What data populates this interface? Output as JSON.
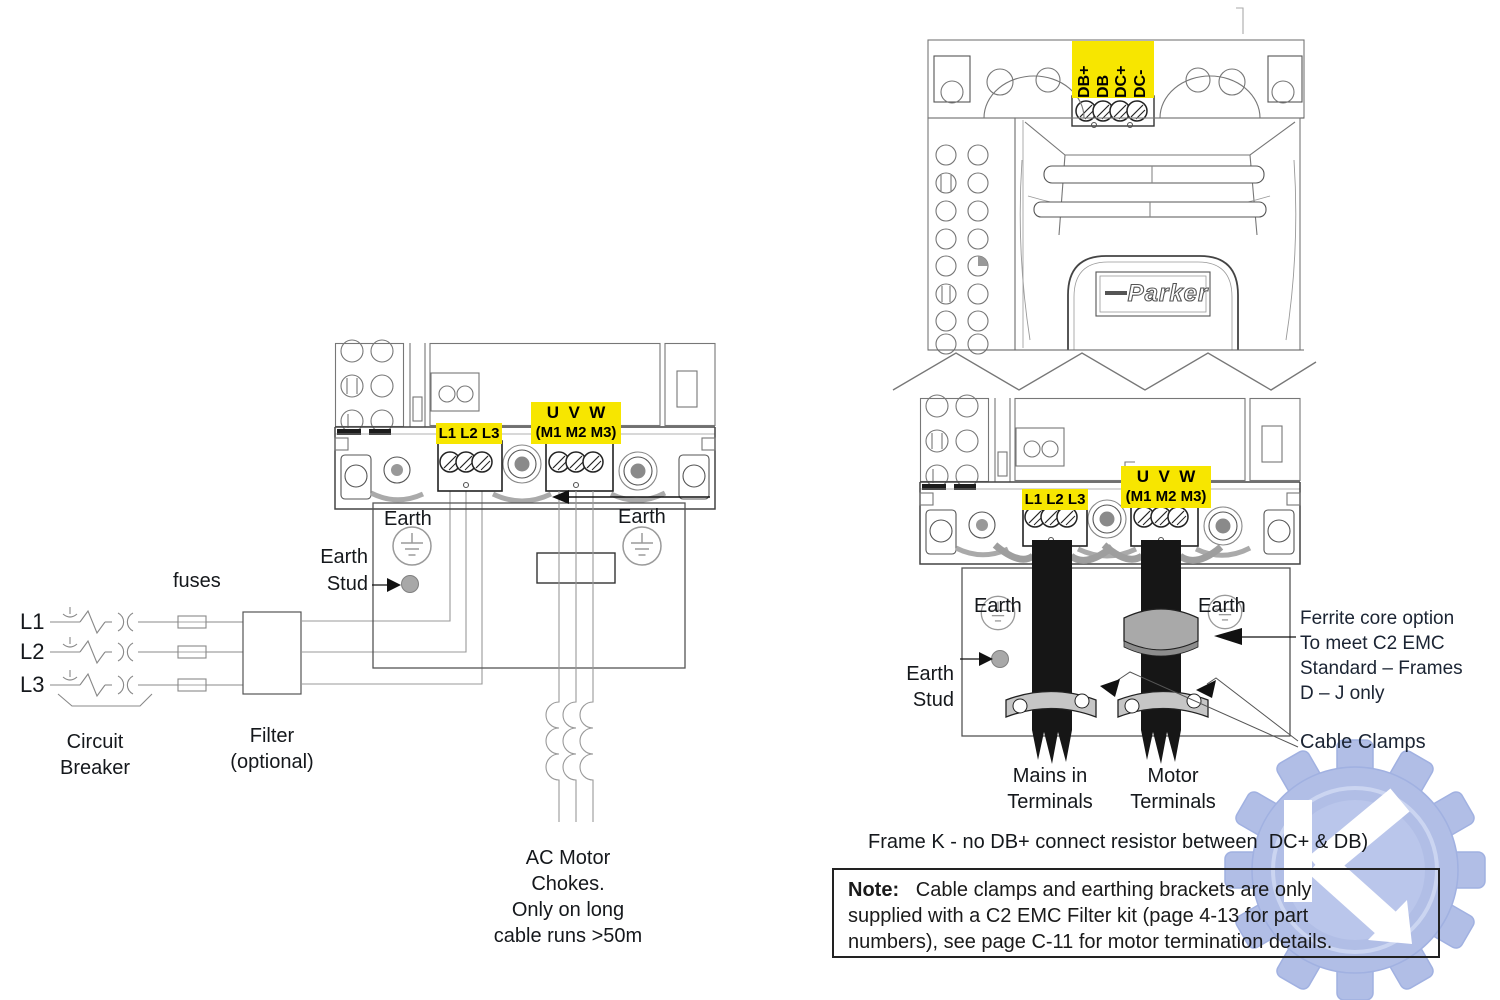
{
  "colors": {
    "highlight_yellow": "#F7E600",
    "watermark_blue": "#ADBBE5",
    "cable_black": "#161616",
    "clamp_gray": "#C6C6C6",
    "ferrite_gray": "#A9A9A9",
    "line_gray": "#777777",
    "text_black": "#15181C"
  },
  "left_circuit": {
    "phases": [
      "L1",
      "L2",
      "L3"
    ],
    "fuses_label": "fuses",
    "breaker_label": [
      "Circuit",
      "Breaker"
    ],
    "filter_label": [
      "Filter",
      "(optional)"
    ]
  },
  "middle_drive": {
    "mains_label": "L1 L2 L3",
    "motor_label_top": "U  V  W",
    "motor_label_bottom": "(M1 M2 M3)",
    "earth_left": "Earth",
    "earth_right": "Earth",
    "earth_stud": [
      "Earth",
      "Stud"
    ],
    "chokes_note": [
      "AC Motor",
      "Chokes.",
      "Only on long",
      "cable runs >50m"
    ]
  },
  "right_drive": {
    "dc_terminals": [
      "DB+",
      "DB",
      "DC+",
      "DC-"
    ],
    "brand": "Parker",
    "mains_label": "L1 L2 L3",
    "motor_label_top": "U  V  W",
    "motor_label_bottom": "(M1 M2 M3)",
    "earth_left": "Earth",
    "earth_right": "Earth",
    "earth_stud": [
      "Earth",
      "Stud"
    ],
    "mains_in_terminals": [
      "Mains in",
      "Terminals"
    ],
    "motor_terminals": [
      "Motor",
      "Terminals"
    ],
    "ferrite_note": [
      "Ferrite core option",
      "To meet C2 EMC",
      "Standard – Frames",
      "D – J only"
    ],
    "cable_clamps": "Cable Clamps"
  },
  "footer": {
    "frame_k_note": "Frame K - no DB+ connect resistor between  DC+ & DB)",
    "note_label": "Note:",
    "note_line1": "   Cable clamps and earthing brackets are only",
    "note_line2": "supplied with a C2 EMC Filter kit (page 4-13 for part",
    "note_line3": "numbers), see page C-11 for motor termination details."
  }
}
